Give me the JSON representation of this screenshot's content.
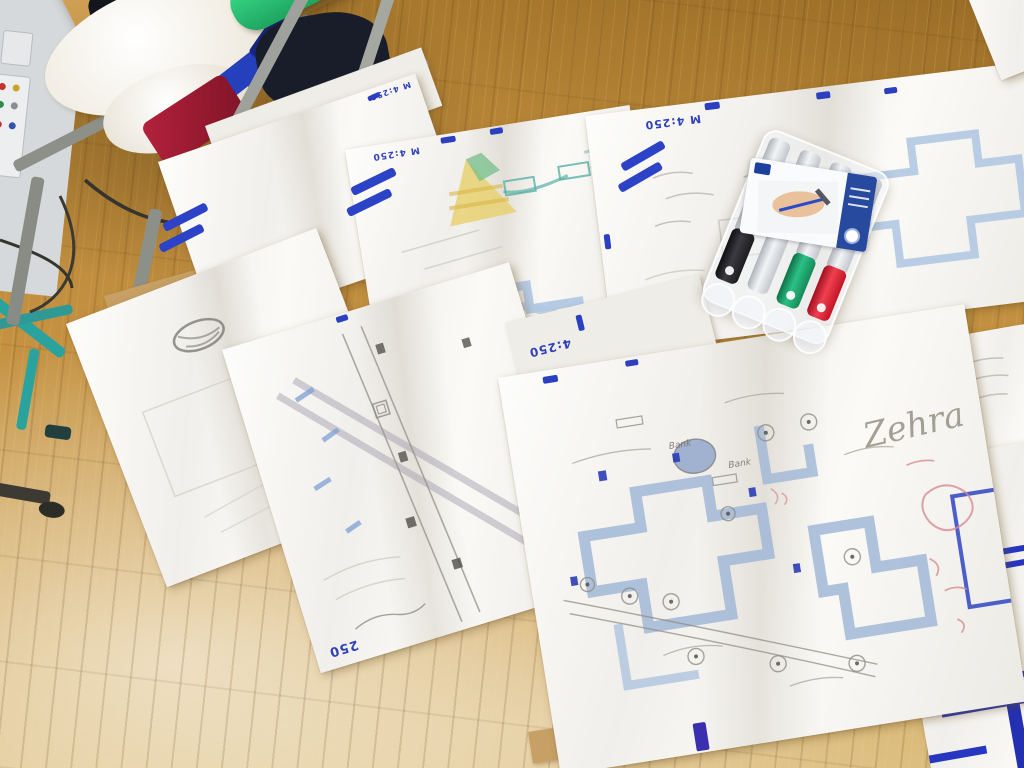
{
  "labels": {
    "scale": "M 4:250",
    "scale_short": "4:250",
    "corner": "250",
    "signature": "Zehra",
    "bank": "Bank"
  },
  "marker_set": {
    "slots": 4,
    "cap_colors": [
      "black",
      "silver",
      "green",
      "red"
    ]
  },
  "colors": {
    "floor_wood": "#c49242",
    "paper": "#f5f3ef",
    "plan_light_blue": "#9fb6d6",
    "marker_dark_blue": "#2b3fc0",
    "pencil_gray": "#8f8d88",
    "red_pencil": "#d68f94",
    "chair_green": "#2ecb7c",
    "chair_teal": "#2aa39e",
    "kraft_paper": "#c7a065",
    "marker_black": "#232326",
    "marker_green": "#1da06b",
    "marker_red": "#d81f2f"
  }
}
